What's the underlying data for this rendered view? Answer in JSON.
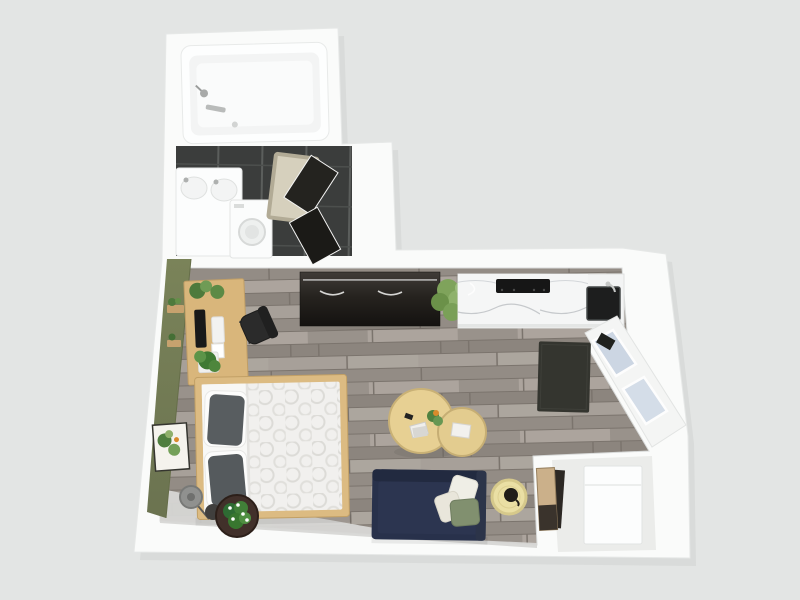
{
  "scene": {
    "type": "3d-floor-plan-render",
    "view": "top-down",
    "subject": "studio-apartment"
  },
  "colors": {
    "background": "#e3e5e4",
    "wall": "#fafbfa",
    "wall_shadow": "#cfd1d0",
    "floor_wood": "#9d968f",
    "tile_dark": "#3b3d3c",
    "green_wall": "#7a8359",
    "desk_wood": "#d9b67b",
    "bed_frame": "#dcbb82",
    "duvet_white": "#f1f0ee",
    "pillow_gray": "#585d60",
    "sofa_navy": "#28314b",
    "cushion_sage": "#81906f",
    "cushion_cream": "#efeee6",
    "pouf_yellow": "#eadfa4",
    "coffee_table_wood": "#e7d093",
    "sideboard_dark": "#26231f",
    "counter_white": "#f5f6f6",
    "cooktop_black": "#161616",
    "sink_black": "#1d1e1e",
    "window_glass": "#ccd6e3",
    "rug_charcoal": "#34352f",
    "bath_mat": "#d6d0bd",
    "concrete_light": "#d7d7d5",
    "plant_green": "#6f9b55",
    "chair_black": "#2b2b2b",
    "stool_brown": "#41302a",
    "art_beige": "#cbb08a"
  },
  "objects": {
    "rooms": [
      "bathroom",
      "entry-closet",
      "main-living-room",
      "kitchen-corner"
    ],
    "furniture": [
      "bathtub",
      "vanity-sink",
      "washing-machine",
      "bath-mat",
      "dark-closet-doors",
      "sideboard",
      "kitchen-counter",
      "cooktop",
      "kitchen-sink",
      "counter-plant",
      "desk",
      "desk-monitor",
      "office-chair",
      "double-bed",
      "floor-lamp",
      "plant-stool",
      "nesting-coffee-tables",
      "navy-sofa",
      "sofa-cushions",
      "round-pouf",
      "area-rug",
      "angled-windows",
      "refrigerator-cabinet",
      "leaning-artwork",
      "green-wall-art",
      "wall-shelves"
    ]
  }
}
